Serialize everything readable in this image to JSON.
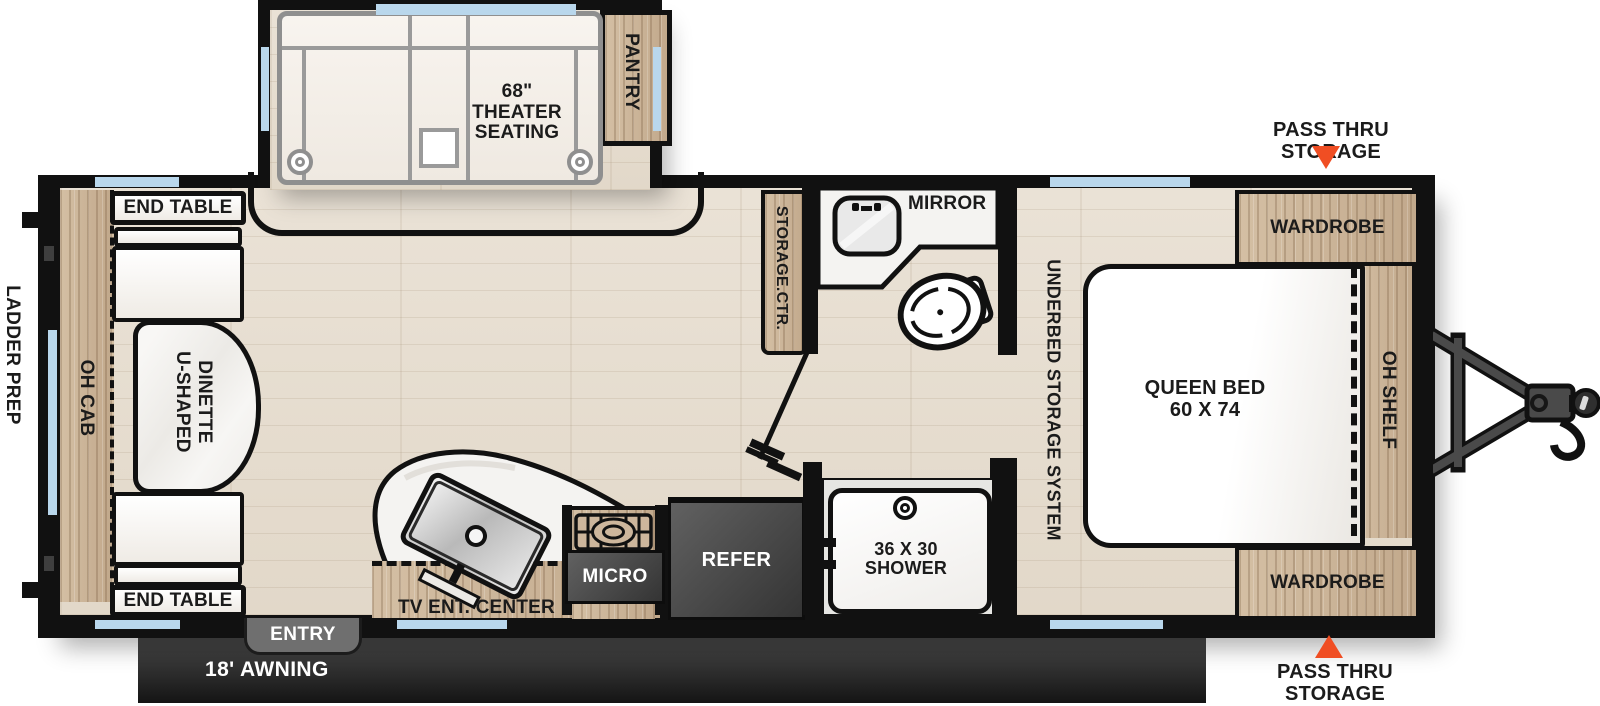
{
  "colors": {
    "accent_orange": "#F04E23",
    "wall_black": "#111111",
    "window_blue": "#B9D7EC",
    "wood_tan": "#CDB69C",
    "appliance_gray": "#4A4A4A"
  },
  "exterior": {
    "ladder_prep": "LADDER PREP",
    "pass_thru_top": "PASS THRU STORAGE",
    "pass_thru_bottom": "PASS THRU STORAGE",
    "awning": "18' AWNING",
    "entry": "ENTRY"
  },
  "living_area": {
    "theater_line1": "68\"",
    "theater_line2": "THEATER",
    "theater_line3": "SEATING",
    "pantry": "PANTRY",
    "end_table_top": "END TABLE",
    "end_table_bottom": "END TABLE",
    "dinette_line1": "U-SHAPED",
    "dinette_line2": "DINETTE",
    "oh_cab": "OH CAB"
  },
  "kitchen": {
    "tv_ent_center": "TV ENT. CENTER",
    "micro": "MICRO",
    "refer": "REFER"
  },
  "bathroom": {
    "mirror": "MIRROR",
    "storage_ctr": "STORAGE.CTR.",
    "shower_line1": "36 X 30",
    "shower_line2": "SHOWER"
  },
  "bedroom": {
    "wardrobe_top": "WARDROBE",
    "wardrobe_bottom": "WARDROBE",
    "queen_line1": "QUEEN BED",
    "queen_line2": "60 X 74",
    "oh_shelf": "OH SHELF",
    "underbed": "UNDERBED STORAGE SYSTEM"
  }
}
